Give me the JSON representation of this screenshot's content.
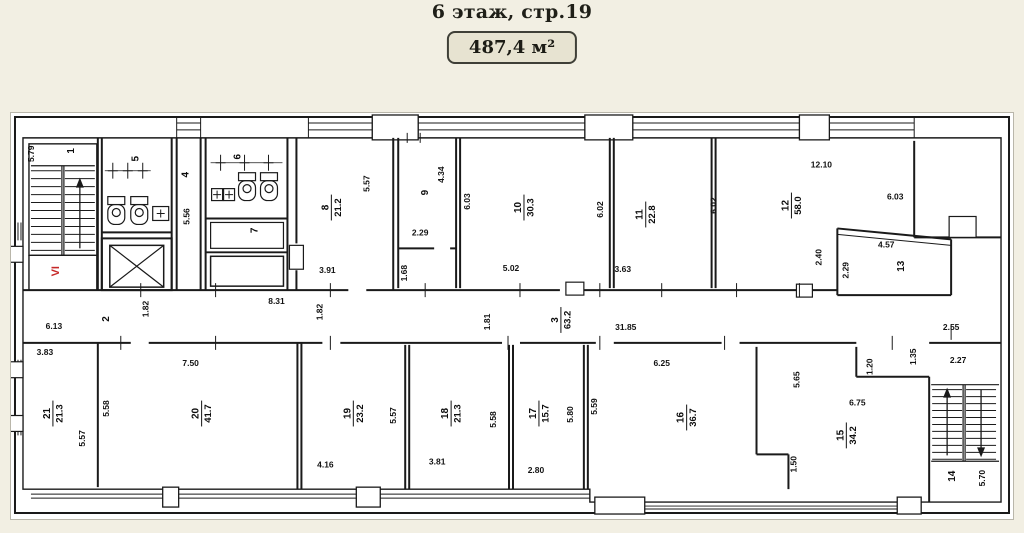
{
  "header": {
    "title": "6 этаж, стр.19",
    "area_badge": "487,4 м²"
  },
  "plan": {
    "floor_marker": {
      "text": "VI",
      "x": 58,
      "y": 271,
      "rot": -90,
      "color": "#c62828"
    },
    "rooms": [
      {
        "number": "1",
        "x": 73,
        "y": 150
      },
      {
        "number": "5",
        "x": 138,
        "y": 158
      },
      {
        "number": "4",
        "x": 188,
        "y": 174
      },
      {
        "number": "6",
        "x": 240,
        "y": 156
      },
      {
        "number": "7",
        "x": 257,
        "y": 230
      },
      {
        "number": "8",
        "area": "21.2",
        "x": 331,
        "y": 207
      },
      {
        "number": "9",
        "x": 428,
        "y": 192
      },
      {
        "number": "10",
        "area": "30.3",
        "x": 524,
        "y": 207
      },
      {
        "number": "11",
        "area": "22.8",
        "x": 646,
        "y": 214
      },
      {
        "number": "12",
        "area": "58.0",
        "x": 792,
        "y": 205
      },
      {
        "number": "13",
        "x": 905,
        "y": 266
      },
      {
        "number": "2",
        "x": 108,
        "y": 319
      },
      {
        "number": "3",
        "area": "63.2",
        "x": 561,
        "y": 320
      },
      {
        "number": "14",
        "x": 956,
        "y": 477
      },
      {
        "number": "15",
        "area": "34.2",
        "x": 847,
        "y": 436
      },
      {
        "number": "16",
        "area": "36.7",
        "x": 687,
        "y": 418
      },
      {
        "number": "17",
        "area": "15.7",
        "x": 539,
        "y": 414
      },
      {
        "number": "18",
        "area": "21.3",
        "x": 451,
        "y": 414
      },
      {
        "number": "19",
        "area": "23.2",
        "x": 353,
        "y": 414
      },
      {
        "number": "20",
        "area": "41.7",
        "x": 201,
        "y": 414
      },
      {
        "number": "21",
        "area": "21.3",
        "x": 52,
        "y": 414
      }
    ],
    "dimensions": [
      {
        "text": "5.79",
        "x": 33,
        "y": 153,
        "rot": -90
      },
      {
        "text": "5.57",
        "x": 369,
        "y": 183,
        "rot": -90
      },
      {
        "text": "3.91",
        "x": 327,
        "y": 273
      },
      {
        "text": "5.56",
        "x": 189,
        "y": 216,
        "rot": -90
      },
      {
        "text": "4.34",
        "x": 444,
        "y": 174,
        "rot": -90
      },
      {
        "text": "2.29",
        "x": 420,
        "y": 235
      },
      {
        "text": "1.68",
        "x": 407,
        "y": 273,
        "rot": -90
      },
      {
        "text": "6.03",
        "x": 470,
        "y": 201,
        "rot": -90
      },
      {
        "text": "5.02",
        "x": 511,
        "y": 271
      },
      {
        "text": "6.02",
        "x": 603,
        "y": 209,
        "rot": -90
      },
      {
        "text": "3.63",
        "x": 623,
        "y": 272
      },
      {
        "text": "6.02",
        "x": 717,
        "y": 205,
        "rot": -90
      },
      {
        "text": "12.10",
        "x": 822,
        "y": 167
      },
      {
        "text": "6.03",
        "x": 896,
        "y": 199
      },
      {
        "text": "2.40",
        "x": 822,
        "y": 257,
        "rot": -90
      },
      {
        "text": "2.29",
        "x": 849,
        "y": 270,
        "rot": -90
      },
      {
        "text": "4.57",
        "x": 887,
        "y": 247
      },
      {
        "text": "6.13",
        "x": 53,
        "y": 329
      },
      {
        "text": "1.82",
        "x": 148,
        "y": 309,
        "rot": -90
      },
      {
        "text": "8.31",
        "x": 276,
        "y": 304
      },
      {
        "text": "1.82",
        "x": 322,
        "y": 312,
        "rot": -90
      },
      {
        "text": "1.81",
        "x": 490,
        "y": 322,
        "rot": -90
      },
      {
        "text": "31.85",
        "x": 626,
        "y": 330
      },
      {
        "text": "2.55",
        "x": 952,
        "y": 330
      },
      {
        "text": "3.83",
        "x": 44,
        "y": 355
      },
      {
        "text": "5.57",
        "x": 84,
        "y": 439,
        "rot": -90
      },
      {
        "text": "5.58",
        "x": 108,
        "y": 409,
        "rot": -90
      },
      {
        "text": "7.50",
        "x": 190,
        "y": 366
      },
      {
        "text": "4.16",
        "x": 325,
        "y": 468
      },
      {
        "text": "5.57",
        "x": 396,
        "y": 416,
        "rot": -90
      },
      {
        "text": "3.81",
        "x": 437,
        "y": 465
      },
      {
        "text": "5.58",
        "x": 496,
        "y": 420,
        "rot": -90
      },
      {
        "text": "2.80",
        "x": 536,
        "y": 474
      },
      {
        "text": "5.80",
        "x": 573,
        "y": 415,
        "rot": -90
      },
      {
        "text": "5.59",
        "x": 597,
        "y": 407,
        "rot": -90
      },
      {
        "text": "6.25",
        "x": 662,
        "y": 366
      },
      {
        "text": "5.65",
        "x": 800,
        "y": 380,
        "rot": -90
      },
      {
        "text": "1.20",
        "x": 873,
        "y": 367,
        "rot": -90
      },
      {
        "text": "1.35",
        "x": 917,
        "y": 357,
        "rot": -90
      },
      {
        "text": "2.27",
        "x": 959,
        "y": 363
      },
      {
        "text": "6.75",
        "x": 858,
        "y": 406
      },
      {
        "text": "1.50",
        "x": 797,
        "y": 465,
        "rot": -90
      },
      {
        "text": "5.70",
        "x": 986,
        "y": 479,
        "rot": -90
      }
    ]
  }
}
